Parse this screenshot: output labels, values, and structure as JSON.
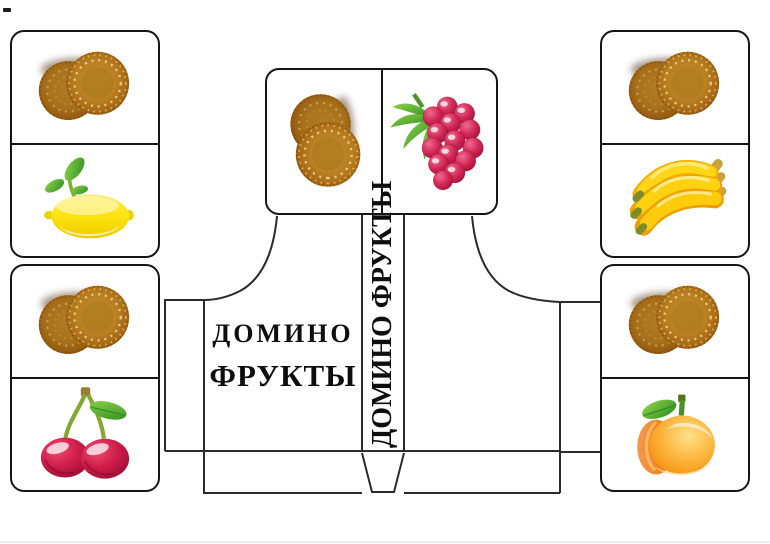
{
  "page": {
    "background": "#ffffff"
  },
  "box_template": {
    "front_label_line1": "ДОМИНО",
    "front_label_line2": "ФРУКТЫ",
    "spine_label": "ДОМИНО ФРУКТЫ"
  },
  "tiles": [
    {
      "id": "tile-left-top",
      "orientation": "vertical",
      "halves": [
        "kiwi",
        "lemon"
      ]
    },
    {
      "id": "tile-left-bottom",
      "orientation": "vertical",
      "halves": [
        "kiwi",
        "cherry"
      ]
    },
    {
      "id": "tile-center-top",
      "orientation": "horizontal",
      "halves": [
        "kiwi",
        "raspberry"
      ]
    },
    {
      "id": "tile-right-top",
      "orientation": "vertical",
      "halves": [
        "kiwi",
        "banana"
      ]
    },
    {
      "id": "tile-right-bottom",
      "orientation": "vertical",
      "halves": [
        "kiwi",
        "apricot"
      ]
    }
  ],
  "fruit_symbols": {
    "kiwi": "fruit-kiwi",
    "lemon": "fruit-lemon",
    "cherry": "fruit-cherry",
    "raspberry": "fruit-rasp",
    "banana": "fruit-banana",
    "apricot": "fruit-apricot"
  },
  "colors": {
    "cutout_outline": "#2b2b2b",
    "tile_border": "#151515",
    "label_text": "#0e0e0e",
    "kiwi_brown": "#a96d15",
    "lemon_yellow": "#ffe81e",
    "cherry_red": "#d01d4a",
    "banana_yellow": "#ffd211",
    "apricot_orange": "#f59008",
    "raspberry_red": "#d42a58",
    "leaf_green": "#3f9a28"
  }
}
